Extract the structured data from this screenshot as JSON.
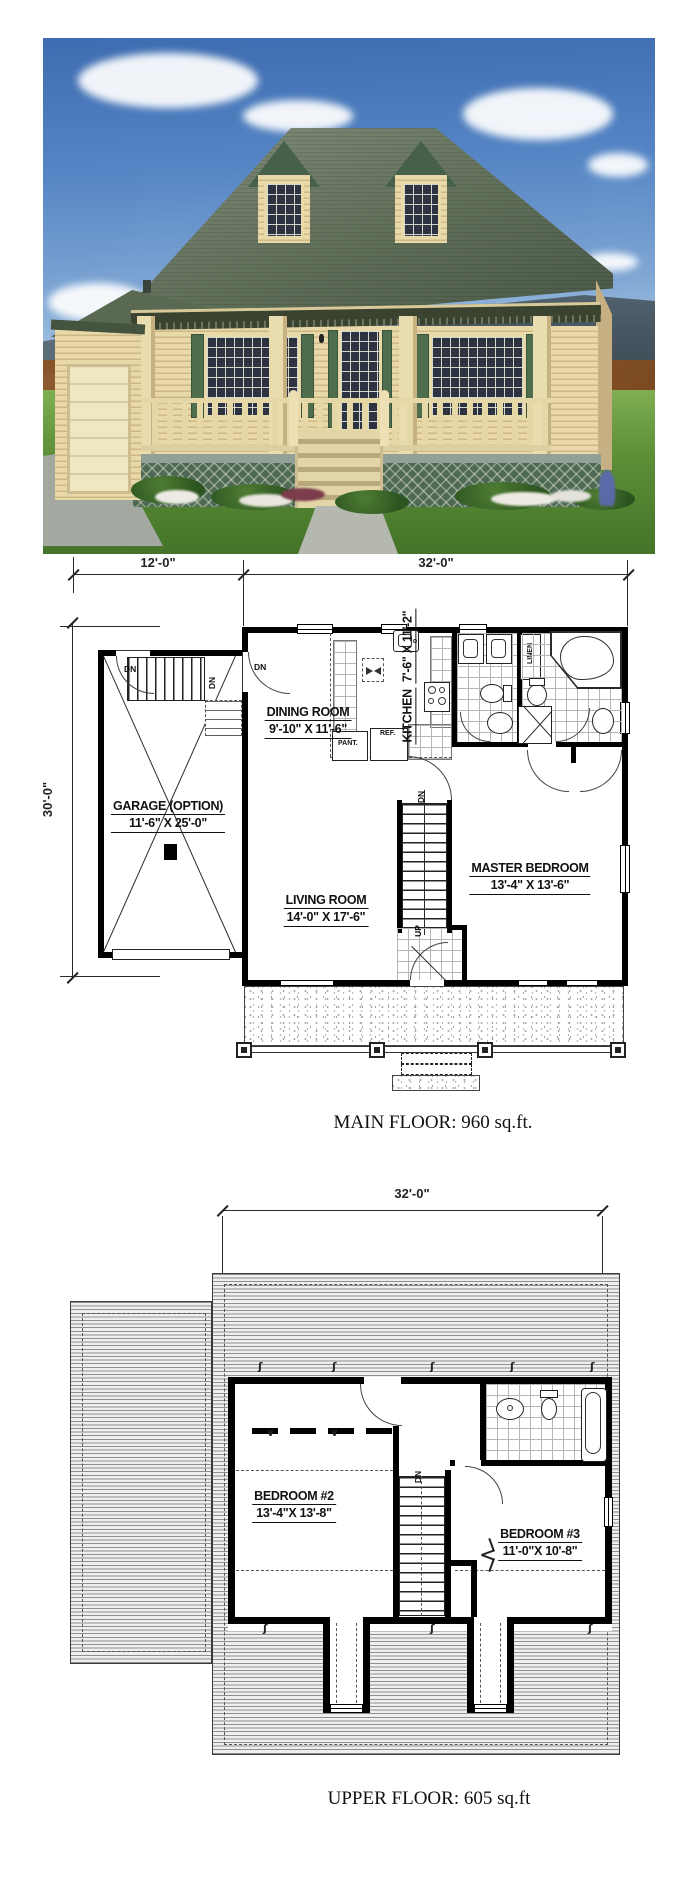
{
  "palette": {
    "roof_green": "#5a6a52",
    "siding_cream": "#e8dcae",
    "trim_green": "#4f6e4e",
    "sky_blue": "#4a7fc1",
    "grass_green": "#5c8f3e",
    "plan_ink": "#000000"
  },
  "main_floor": {
    "dim_left": "12'-0\"",
    "dim_right": "32'-0\"",
    "dim_height": "30'-0\"",
    "rooms": [
      {
        "name": "GARAGE (OPTION)",
        "size": "11'-6\" X 25'-0\""
      },
      {
        "name": "DINING ROOM",
        "size": "9'-10\" X 11'-6\""
      },
      {
        "name": "KITCHEN",
        "size": "7'-6\" X 11'-2\""
      },
      {
        "name": "LIVING ROOM",
        "size": "14'-0\" X 17'-6\""
      },
      {
        "name": "MASTER BEDROOM",
        "size": "13'-4\" X 13'-6\""
      }
    ],
    "fixtures": {
      "pantry": "PANT.",
      "fridge": "REF.",
      "linen": "LINEN"
    },
    "labels": {
      "down": "DN",
      "up": "UP"
    },
    "caption": "MAIN FLOOR: 960 sq.ft."
  },
  "upper_floor": {
    "dim_width": "32'-0\"",
    "rooms": [
      {
        "name": "BEDROOM #2",
        "size": "13'-4\"X 13'-8\""
      },
      {
        "name": "BEDROOM #3",
        "size": "11'-0\"X 10'-8\""
      }
    ],
    "labels": {
      "down": "DN"
    },
    "caption": "UPPER FLOOR: 605 sq.ft"
  },
  "symbols": {
    "break_mark": "ʃ",
    "window_mark": "∨"
  }
}
